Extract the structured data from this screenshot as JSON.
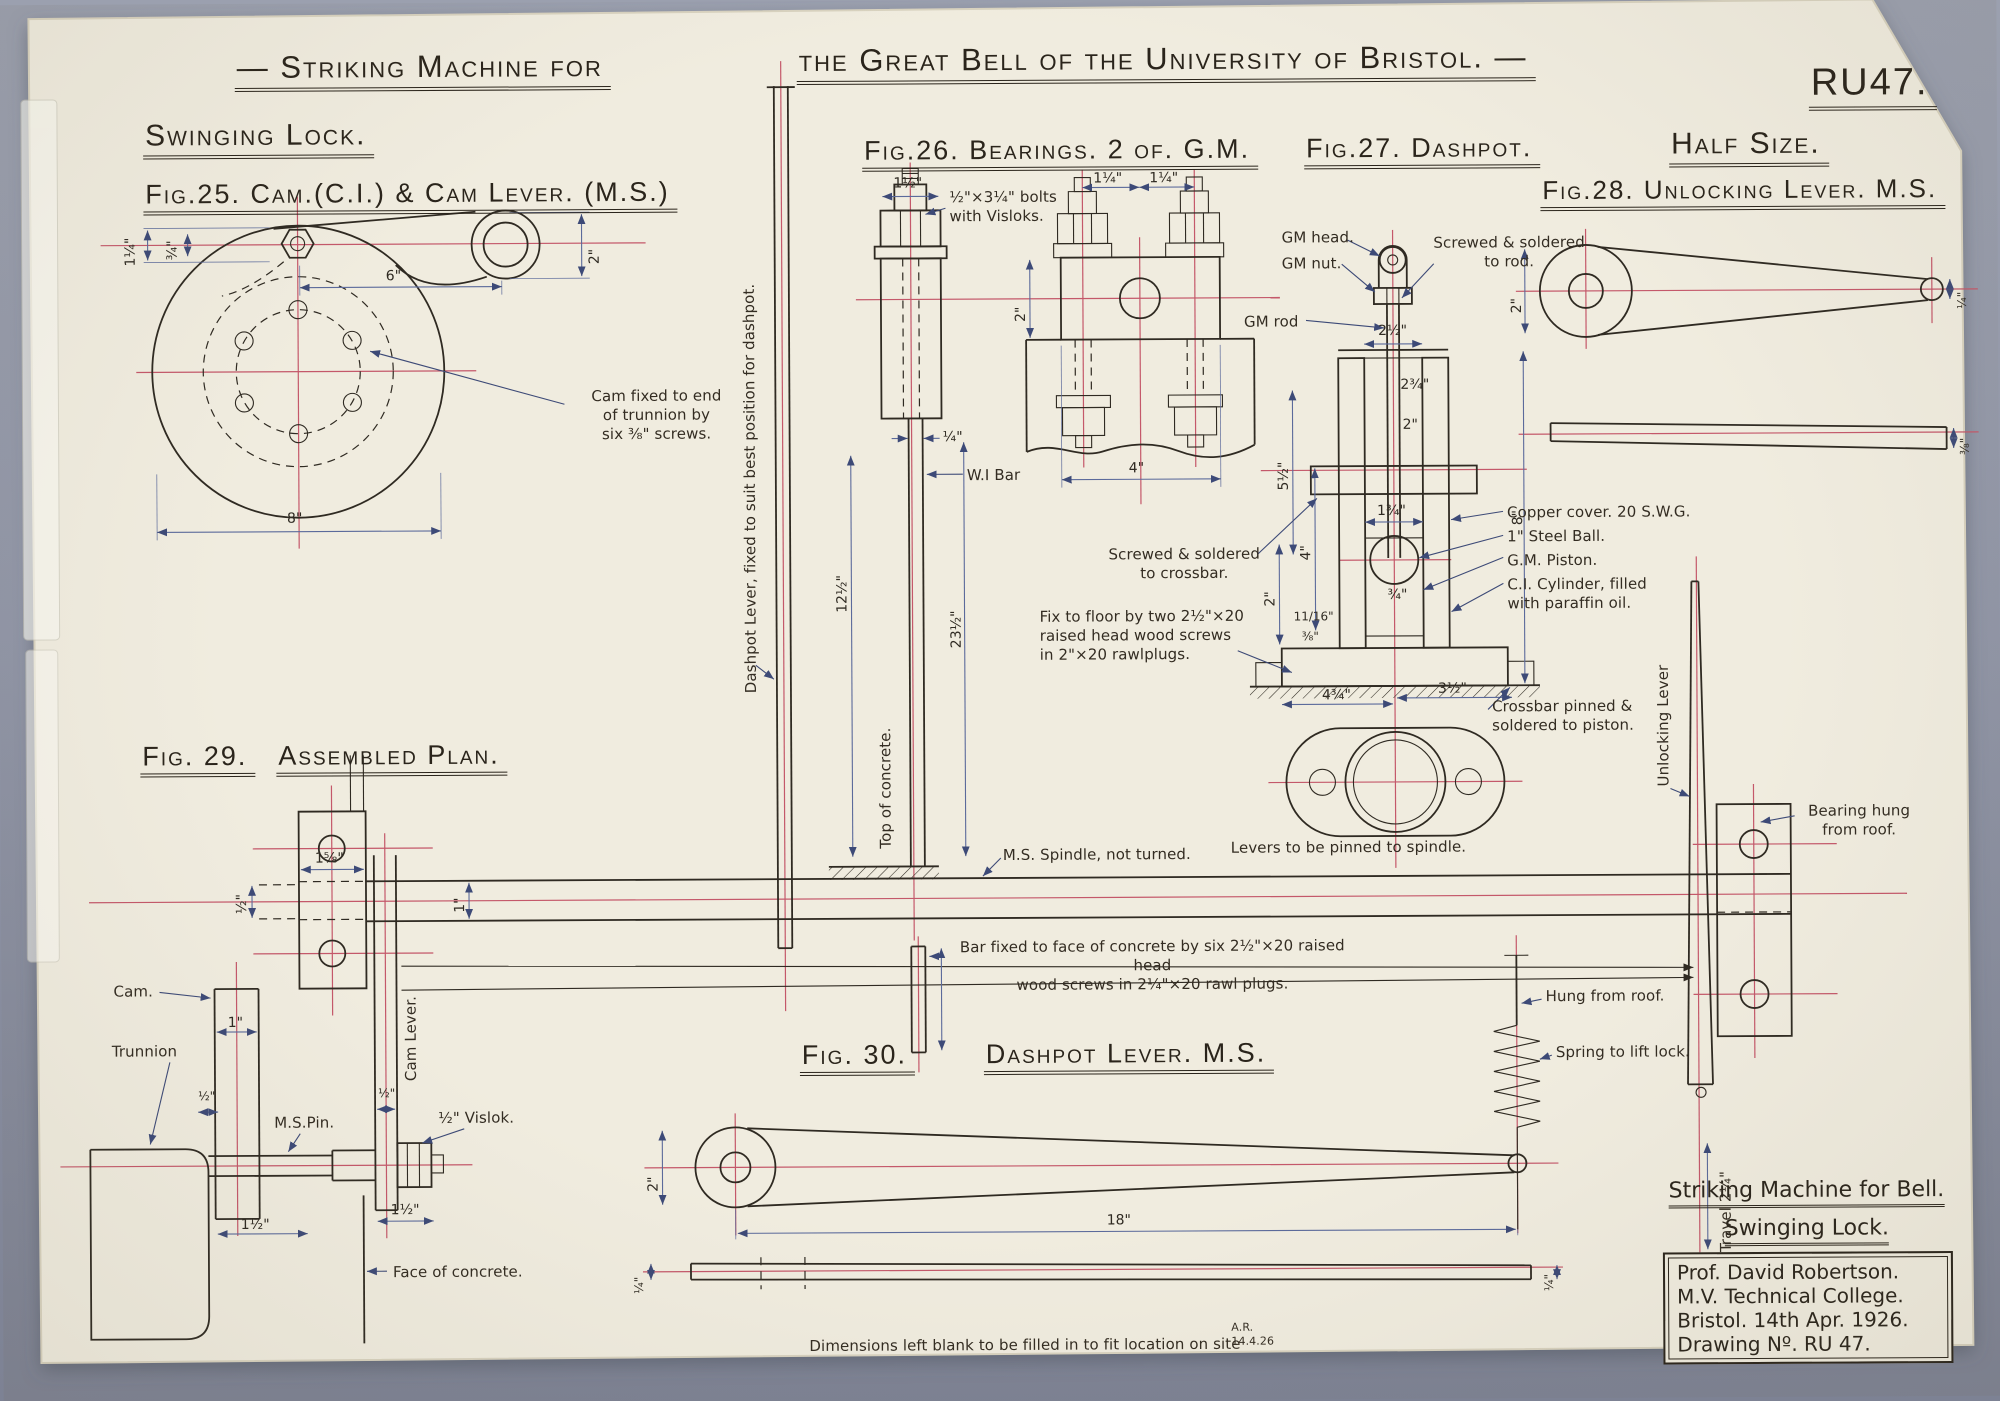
{
  "meta": {
    "drawing_no": "RU47.",
    "scale_note": "Half Size."
  },
  "title": {
    "left": "— Striking Machine for",
    "right": "the Great Bell of the University of Bristol. —"
  },
  "headings": {
    "swinging_lock": "Swinging Lock.",
    "fig25": "Fig.25. Cam.(C.I.) & Cam Lever. (M.S.)",
    "fig26": "Fig.26. Bearings. 2 of. G.M.",
    "fig27": "Fig.27. Dashpot.",
    "fig28": "Fig.28. Unlocking Lever. M.S.",
    "fig29_no": "Fig. 29.",
    "fig29_name": "Assembled Plan.",
    "fig30_no": "Fig. 30.",
    "fig30_name": "Dashpot Lever. M.S."
  },
  "labels": {
    "cam_screws": "Cam fixed to end\nof trunnion by\nsix ⅜\" screws.",
    "dashpot_lever_v": "Dashpot Lever, fixed to suit best position for dashpot.",
    "bolts_visloks": "½\"×3¼\" bolts\nwith Visloks.",
    "wi_bar": "W.I Bar",
    "top_concrete_v": "Top of concrete.",
    "gm_head": "GM head.",
    "gm_nut": "GM nut.",
    "screwed_rod": "Screwed & soldered\nto rod.",
    "gm_rod": "GM rod",
    "copper_cover": "Copper cover. 20 S.W.G.",
    "steel_ball": "1\" Steel Ball.",
    "gm_piston": "G.M. Piston.",
    "ci_cylinder": "C.I. Cylinder, filled\nwith paraffin oil.",
    "crossbar_pinned": "Crossbar pinned &\nsoldered to piston.",
    "screwed_crossbar": "Screwed & soldered\nto crossbar.",
    "fix_floor": "Fix to floor by two 2½\"×20\nraised head wood screws\nin 2\"×20 rawlplugs.",
    "ms_spindle": "M.S. Spindle, not turned.",
    "levers_pinned": "Levers to be pinned to spindle.",
    "bar_fixed": "Bar fixed to face of concrete by six 2½\"×20 raised head\nwood screws in 2¼\"×20 rawl plugs.",
    "unlocking_lever_v": "Unlocking Lever",
    "bearing_hung": "Bearing hung\nfrom roof.",
    "hung_roof": "Hung from roof.",
    "spring_lift": "Spring to lift lock.",
    "travel_v": "Travel 2¼\"",
    "ms_pin": "M.S.Pin.",
    "vislok": "½\" Vislok.",
    "cam": "Cam.",
    "trunnion": "Trunnion",
    "cam_lever_v": "Cam Lever.",
    "face_concrete": "Face of concrete.",
    "blank_note": "Dimensions left blank to be filled in to fit location on site",
    "initials": "A.R.\n14.4.26"
  },
  "dims": {
    "f25_a": "1¼\"",
    "f25_b": "¾\"",
    "f25_c": "6\"",
    "f25_d": "2\"",
    "f25_e": "8\"",
    "f26_a": "1½\"",
    "f26_b": "¼\"",
    "f26_c": "12½\"",
    "f26_d": "23½\"",
    "f26_e": "1¼\"",
    "f26_f": "1¼\"",
    "f26_g": "2\"",
    "f26_h": "4\"",
    "f27_a": "2½\"",
    "f27_b": "2¾\"",
    "f27_c": "2\"",
    "f27_d": "5½\"",
    "f27_e": "4\"",
    "f27_f": "2\"",
    "f27_g": "8\"",
    "f27_h": "1¾\"",
    "f27_i": "¾\"",
    "f27_j": "11/16\"",
    "f27_k": "⅜\"",
    "f27_l": "4¾\"",
    "f27_m": "3½\"",
    "f28_a": "2\"",
    "f28_b": "¼\"",
    "f28_c": "⅜\"",
    "f29_a": "1⅝\"",
    "f29_b": "½\"",
    "f29_c": "1\"",
    "f29_d": "1\"",
    "f29_e": "½\"",
    "f29_f": "½\"",
    "f29_g": "1½\"",
    "f29_h": "1½\"",
    "f30_a": "2\"",
    "f30_b": "18\"",
    "f30_c": "¼\"",
    "f30_d": "¼\""
  },
  "title_block": {
    "line1": "Striking Machine for Bell.",
    "line2": "Swinging Lock.",
    "box": [
      "Prof. David Robertson.",
      "M.V. Technical College.",
      "Bristol.  14th Apr. 1926.",
      "Drawing Nº. RU 47."
    ]
  }
}
